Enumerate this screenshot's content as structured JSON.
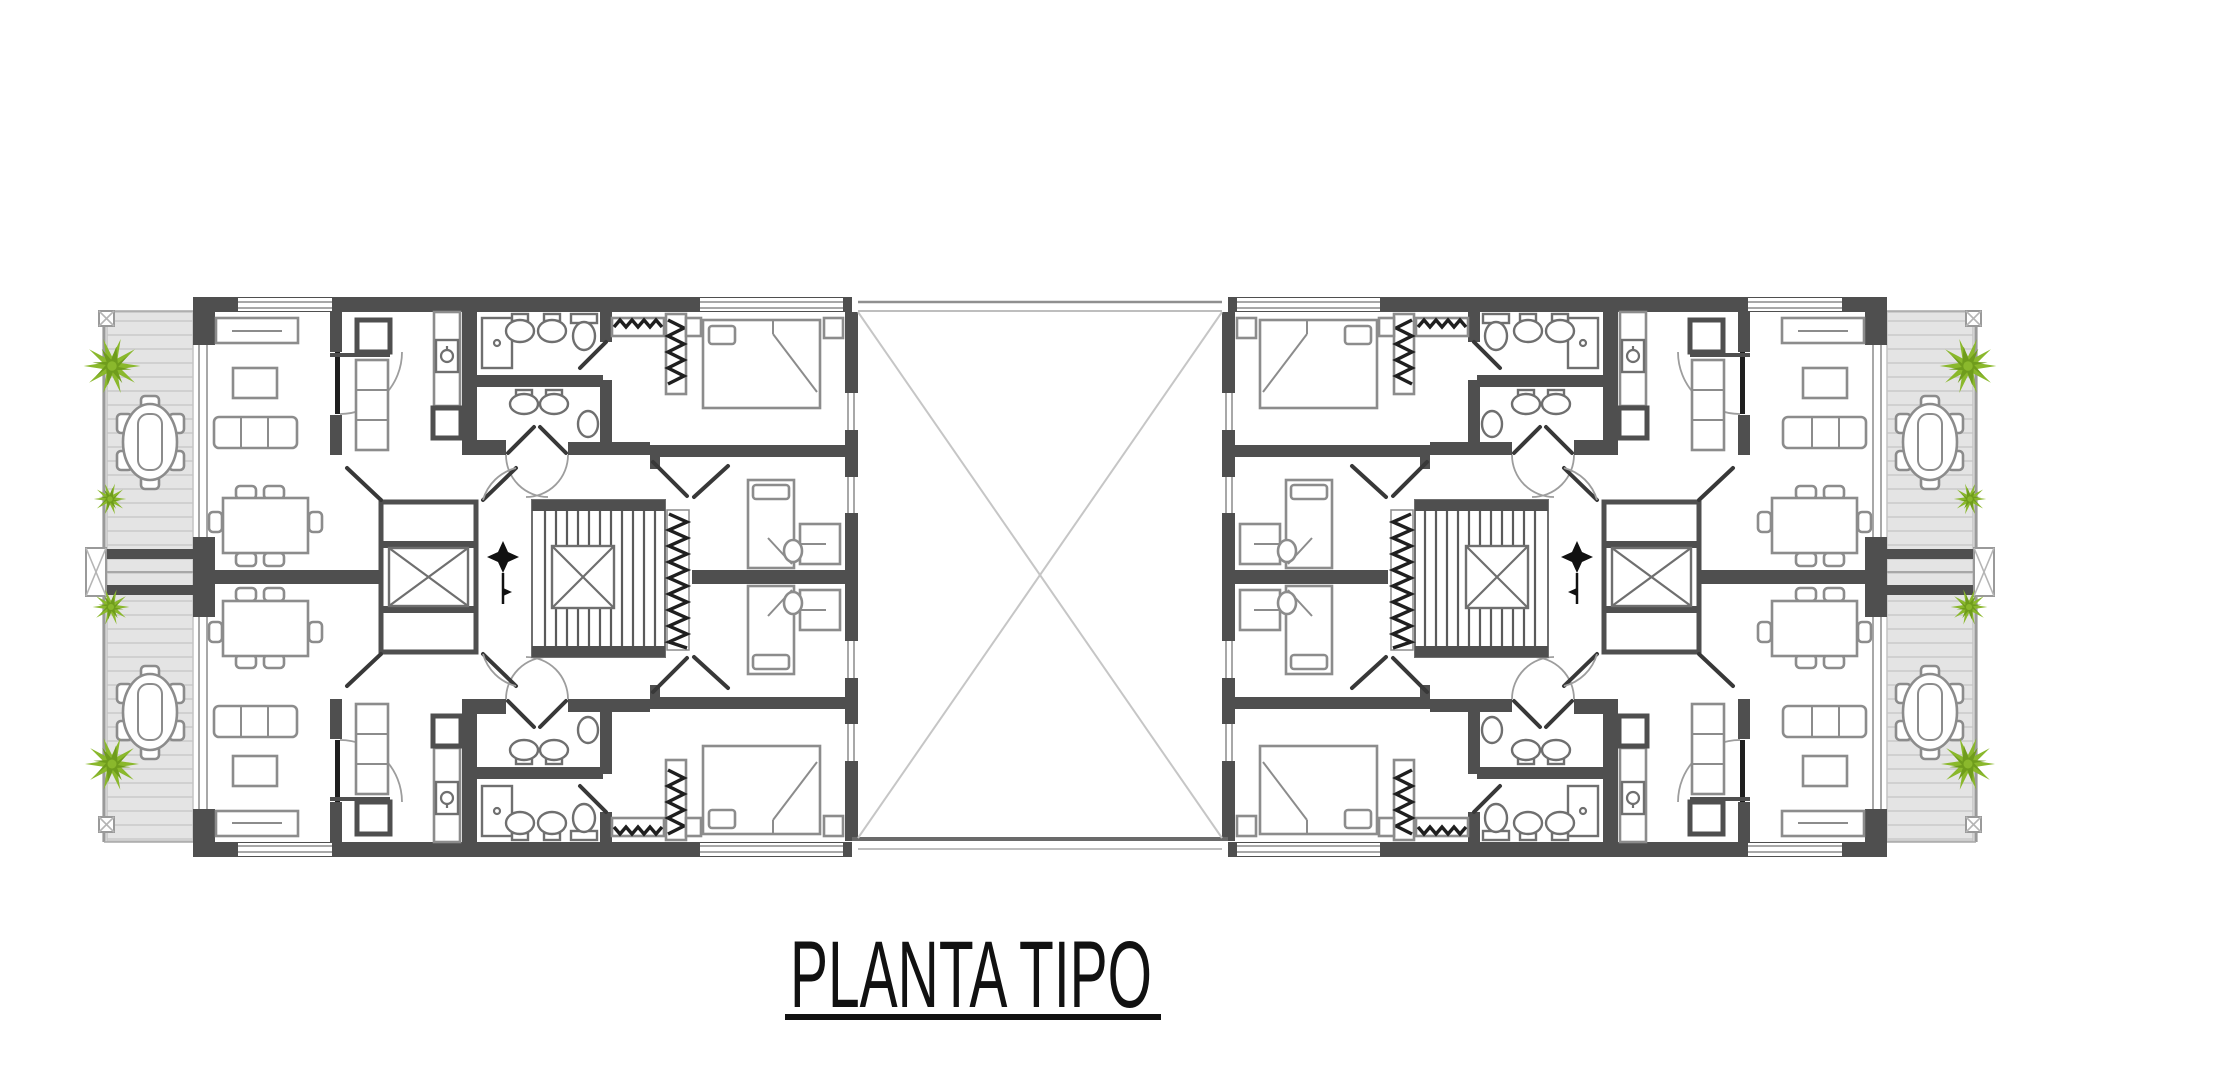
{
  "title": {
    "text": "PLANTA TIPO"
  },
  "colors": {
    "background": "#ffffff",
    "wall": "#4f4f4f",
    "hatch_black": "#1f1f1f",
    "furniture_line": "#8c8c8c",
    "fixture_line": "#6f6f6f",
    "thin_line": "#a8a8a8",
    "terrace_fill": "#e4e4e4",
    "terrace_line": "#d0d0d0",
    "plant_green": "#8ab82c",
    "plant_green_dark": "#6f9c1c",
    "courtyard_line": "#c6c6c6",
    "title_color": "#111111"
  },
  "plan_summary": {
    "apartment_units": 4,
    "stair_cores": 2,
    "elevators": 2,
    "central_courtyard": 1,
    "terraces": 4,
    "outdoor_tables": 4,
    "plants": 8
  },
  "icons": {
    "plant_icon": "green shrub (top view)",
    "north_arrow_icon": "four-point star with stem",
    "elevator_icon": "shaft rectangle with X car",
    "staircase_icon": "treads with X landing",
    "courtyard_icon": "void with crossed diagonals"
  }
}
